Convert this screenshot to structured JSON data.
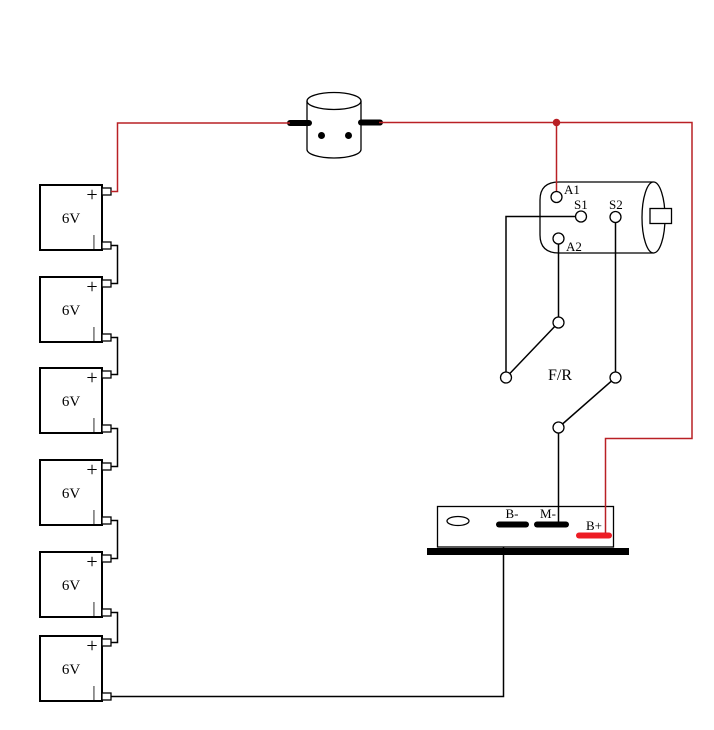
{
  "colors": {
    "background": "#ffffff",
    "wire_red": "#b92025",
    "wire_black": "#000000",
    "b_plus_bar_red": "#ed1c24"
  },
  "battery": {
    "count": 6,
    "voltage_label": "6V",
    "plus_label": "+",
    "minus_label": "|"
  },
  "motor": {
    "terminal_a1": "A1",
    "terminal_s1": "S1",
    "terminal_s2": "S2",
    "terminal_a2": "A2"
  },
  "switch": {
    "label": "F/R"
  },
  "controller": {
    "terminal_b_minus": "B-",
    "terminal_m_minus": "M-",
    "terminal_b_plus": "B+"
  }
}
